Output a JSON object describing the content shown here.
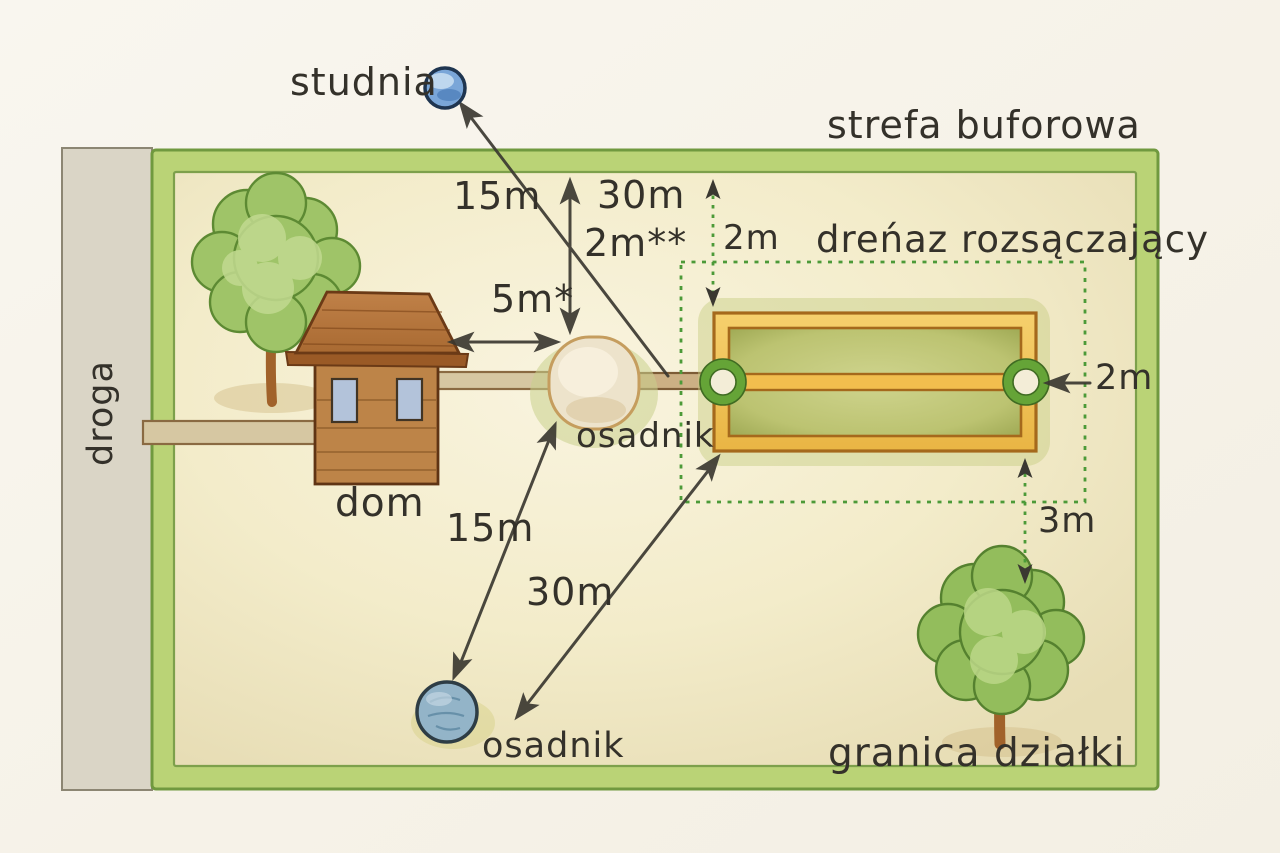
{
  "labels": {
    "well": "studnia",
    "buffer_zone": "strefa buforowa",
    "drain_field": "dreńaz rozsączający",
    "road": "droga",
    "house": "dom",
    "tank_main": "osadnik",
    "tank_lower": "osadnik",
    "plot_boundary": "granica działki"
  },
  "measurements": {
    "well_to_tank": "15m",
    "well_to_drain": "30m",
    "tank_to_boundary": "2m**",
    "house_to_tank": "5m*",
    "drain_top_offset": "2m",
    "drain_right_offset": "2m",
    "drain_to_tree": "3m",
    "tank_to_lower_tank": "15m",
    "drain_to_lower_tank": "30m"
  },
  "colors": {
    "paper": "#f7f4ec",
    "plot_border_green": "#bad376",
    "plot_interior": "#f4edcd",
    "road_grey": "#dad5c6",
    "dashed_green": "#4c9a38",
    "drain_gold": "#f2c45c",
    "drain_olive": "#c2c877",
    "house_brown": "#bd8448",
    "well_blue": "#7aa6d8",
    "lower_tank_blue": "#93b4c8",
    "arrow_ink": "#3a3831"
  }
}
